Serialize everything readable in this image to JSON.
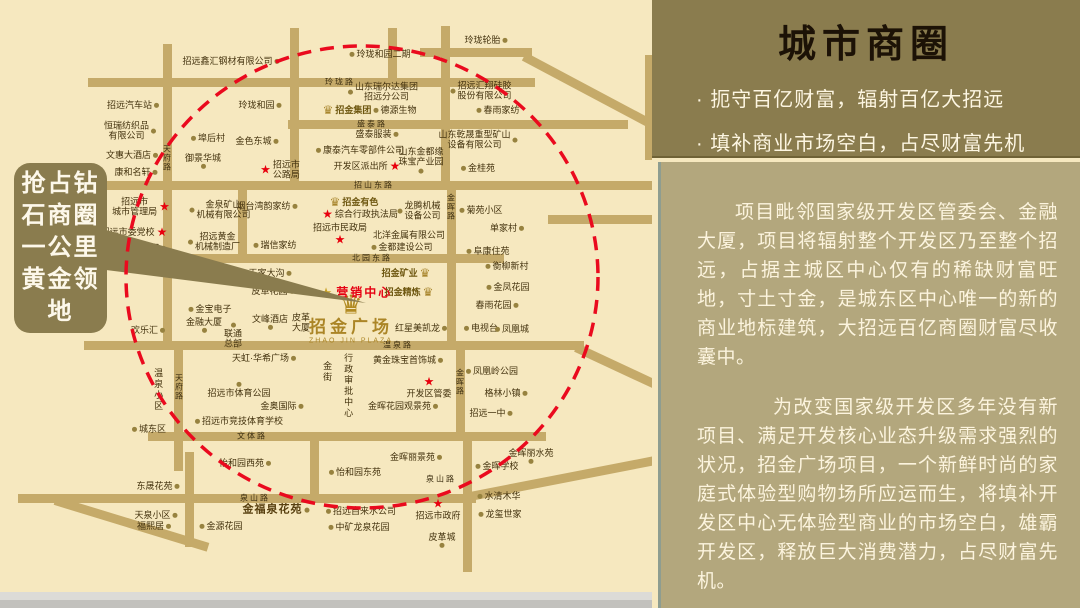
{
  "panel": {
    "title": "城市商圈",
    "bullets": [
      "· 扼守百亿财富，辐射百亿大招远",
      "· 填补商业市场空白，占尽财富先机"
    ],
    "paragraphs": [
      "项目毗邻国家级开发区管委会、金融大厦，项目将辐射整个开发区乃至整个招远，占据主城区中心仅有的稀缺财富旺地，寸土寸金，是城东区中心唯一的新的商业地标建筑，大招远百亿商圈财富尽收囊中。",
      "为改变国家级开发区多年没有新项目、满足开发核心业态升级需求强烈的状况，招金广场项目，一个新鲜时尚的家庭式体验型购物场所应运而生，将填补开发区中心无体验型商业的市场空白，雄霸开发区，释放巨大消费潜力，占尽财富先机。"
    ],
    "colors": {
      "header_bg": "#8a7c4e",
      "body_bg": "#b3a77d",
      "accent_red": "#e8000d"
    }
  },
  "callout": {
    "text": "抢占钻石商圈一公里黄金领地"
  },
  "map": {
    "plaza": {
      "name": "招金广场",
      "latin": "ZHAO JIN PLAZA"
    },
    "marketing_center": "营销中心",
    "circle_color": "#ea0a1e",
    "roads": [
      {
        "x": 88,
        "y": 78,
        "len": 447
      },
      {
        "x": 420,
        "y": 48,
        "len": 112
      },
      {
        "x": 524,
        "y": 52,
        "len": 150,
        "rot": 28
      },
      {
        "x": 288,
        "y": 120,
        "len": 340
      },
      {
        "x": 92,
        "y": 181,
        "len": 566
      },
      {
        "x": 92,
        "y": 254,
        "len": 412
      },
      {
        "x": 84,
        "y": 341,
        "len": 500
      },
      {
        "x": 576,
        "y": 343,
        "len": 125,
        "rot": 25
      },
      {
        "x": 148,
        "y": 432,
        "len": 398
      },
      {
        "x": 18,
        "y": 494,
        "len": 458
      },
      {
        "x": 470,
        "y": 492,
        "len": 195,
        "rot": -11
      },
      {
        "x": 55,
        "y": 496,
        "len": 160,
        "rot": 17
      },
      {
        "x": 548,
        "y": 215,
        "len": 104
      },
      {
        "x": 163,
        "y": 44,
        "len": 302,
        "v": 1
      },
      {
        "x": 174,
        "y": 341,
        "len": 130,
        "v": 1
      },
      {
        "x": 290,
        "y": 28,
        "len": 158,
        "v": 1
      },
      {
        "x": 441,
        "y": 26,
        "len": 158,
        "v": 1
      },
      {
        "x": 447,
        "y": 181,
        "len": 163,
        "v": 1
      },
      {
        "x": 456,
        "y": 341,
        "len": 95,
        "v": 1
      },
      {
        "x": 463,
        "y": 432,
        "len": 140,
        "v": 1
      },
      {
        "x": 310,
        "y": 432,
        "len": 68,
        "v": 1
      },
      {
        "x": 185,
        "y": 452,
        "len": 95,
        "v": 1
      },
      {
        "x": 238,
        "y": 181,
        "len": 76,
        "v": 1
      },
      {
        "x": 388,
        "y": 28,
        "len": 56,
        "v": 1
      },
      {
        "x": 645,
        "y": 55,
        "len": 105,
        "v": 1
      }
    ],
    "road_labels": [
      {
        "t": "玲珑路",
        "x": 340,
        "y": 82
      },
      {
        "t": "盛泰路",
        "x": 372,
        "y": 124
      },
      {
        "t": "招山东路",
        "x": 374,
        "y": 185
      },
      {
        "t": "北园东路",
        "x": 372,
        "y": 258
      },
      {
        "t": "温泉路",
        "x": 398,
        "y": 345
      },
      {
        "t": "文体路",
        "x": 252,
        "y": 436
      },
      {
        "t": "泉山路",
        "x": 255,
        "y": 498
      },
      {
        "t": "泉山路",
        "x": 441,
        "y": 479
      },
      {
        "t": "天府路",
        "x": 167,
        "y": 158,
        "v": 1
      },
      {
        "t": "天府路",
        "x": 179,
        "y": 387,
        "v": 1
      },
      {
        "t": "金晖路",
        "x": 451,
        "y": 207,
        "v": 1
      },
      {
        "t": "金晖路",
        "x": 460,
        "y": 382,
        "v": 1
      }
    ],
    "pois": [
      {
        "t": "招远鑫汇钢材有限公司",
        "x": 231,
        "y": 61,
        "m": "d",
        "s": "r"
      },
      {
        "t": "玲珑轮胎",
        "x": 486,
        "y": 40,
        "m": "d",
        "s": "r"
      },
      {
        "t": "玲珑和园二期",
        "x": 380,
        "y": 54,
        "m": "d",
        "s": "l"
      },
      {
        "t": "招远汽车站",
        "x": 133,
        "y": 105,
        "m": "d",
        "s": "r"
      },
      {
        "t": "玲珑和园",
        "x": 260,
        "y": 105,
        "m": "d",
        "s": "r"
      },
      {
        "t": "恒瑞纺织品\n有限公司",
        "x": 130,
        "y": 131,
        "m": "d",
        "s": "r"
      },
      {
        "t": "埠后村",
        "x": 208,
        "y": 138,
        "m": "d",
        "s": "l"
      },
      {
        "t": "金色东城",
        "x": 257,
        "y": 141,
        "m": "d",
        "s": "r"
      },
      {
        "t": "文惠大酒店",
        "x": 132,
        "y": 155,
        "m": "d",
        "s": "r"
      },
      {
        "t": "御景华城",
        "x": 203,
        "y": 161,
        "m": "d",
        "s": "b"
      },
      {
        "t": "康和名轩",
        "x": 136,
        "y": 172,
        "m": "d",
        "s": "r"
      },
      {
        "t": "山东瑞尔达集团\n招远分公司",
        "x": 383,
        "y": 92,
        "m": "d",
        "s": "l"
      },
      {
        "t": "招远汇翔硅胶\n股份有限公司",
        "x": 481,
        "y": 91,
        "m": "d",
        "s": "l"
      },
      {
        "t": "招金集团",
        "x": 347,
        "y": 110,
        "cls": "gold",
        "m": "e",
        "s": "l"
      },
      {
        "t": "德源生物",
        "x": 395,
        "y": 110,
        "m": "d",
        "s": "l"
      },
      {
        "t": "春雨家纺",
        "x": 498,
        "y": 110,
        "m": "d",
        "s": "l"
      },
      {
        "t": "盛泰服装",
        "x": 377,
        "y": 134,
        "m": "d",
        "s": "r"
      },
      {
        "t": "山东乾晟重型矿山\n设备有限公司",
        "x": 478,
        "y": 140,
        "m": "d",
        "s": "r"
      },
      {
        "t": "康泰汽车零部件公司",
        "x": 360,
        "y": 150,
        "m": "d",
        "s": "l"
      },
      {
        "t": "山东金都缘\n珠宝产业园",
        "x": 421,
        "y": 160,
        "m": "d",
        "s": "b"
      },
      {
        "t": "开发区派出所",
        "x": 367,
        "y": 166,
        "m": "s",
        "s": "r"
      },
      {
        "t": "金桂苑",
        "x": 478,
        "y": 168,
        "m": "d",
        "s": "l"
      },
      {
        "t": "招远市\n公路局",
        "x": 280,
        "y": 170,
        "m": "s",
        "s": "l"
      },
      {
        "t": "招金有色",
        "x": 354,
        "y": 202,
        "cls": "gold",
        "m": "e",
        "s": "l"
      },
      {
        "t": "综合行政执法局",
        "x": 360,
        "y": 214,
        "m": "s",
        "s": "l"
      },
      {
        "t": "龙腾机械\n设备公司",
        "x": 419,
        "y": 211,
        "m": "d",
        "s": "l"
      },
      {
        "t": "菊苑小区",
        "x": 481,
        "y": 210,
        "m": "d",
        "s": "l"
      },
      {
        "t": "单家村",
        "x": 507,
        "y": 228,
        "m": "d",
        "s": "r"
      },
      {
        "t": "招远市\n城市管理局",
        "x": 141,
        "y": 207,
        "m": "s",
        "s": "r"
      },
      {
        "t": "招远市委党校",
        "x": 134,
        "y": 232,
        "m": "s",
        "s": "r"
      },
      {
        "t": "御金都",
        "x": 149,
        "y": 248,
        "m": "d",
        "s": "r"
      },
      {
        "t": "金泉矿山\n机械有限公司",
        "x": 220,
        "y": 210,
        "m": "d",
        "s": "l"
      },
      {
        "t": "烟台湾韵家纺",
        "x": 267,
        "y": 206,
        "m": "d",
        "s": "r"
      },
      {
        "t": "招远黄金\n机械制造厂",
        "x": 214,
        "y": 242,
        "m": "d",
        "s": "l"
      },
      {
        "t": "瑞信家纺",
        "x": 275,
        "y": 245,
        "m": "d",
        "s": "l"
      },
      {
        "t": "招远市民政局",
        "x": 340,
        "y": 234,
        "m": "s",
        "s": "b"
      },
      {
        "t": "北洋金属有限公司",
        "x": 409,
        "y": 235
      },
      {
        "t": "金都建设公司",
        "x": 402,
        "y": 247,
        "m": "d",
        "s": "l"
      },
      {
        "t": "阜康住苑",
        "x": 488,
        "y": 251,
        "m": "d",
        "s": "l"
      },
      {
        "t": "御金府",
        "x": 206,
        "y": 271,
        "m": "d",
        "s": "l"
      },
      {
        "t": "王家大沟",
        "x": 270,
        "y": 273,
        "m": "d",
        "s": "r"
      },
      {
        "t": "皮革花园",
        "x": 273,
        "y": 291,
        "m": "d",
        "s": "r"
      },
      {
        "t": "衡柳新村",
        "x": 507,
        "y": 266,
        "m": "d",
        "s": "l"
      },
      {
        "t": "金凤花园",
        "x": 508,
        "y": 287,
        "m": "d",
        "s": "l"
      },
      {
        "t": "春雨花园",
        "x": 497,
        "y": 305,
        "m": "d",
        "s": "r"
      },
      {
        "t": "招金矿业",
        "x": 406,
        "y": 273,
        "cls": "gold",
        "m": "e",
        "s": "r"
      },
      {
        "t": "招金精炼",
        "x": 409,
        "y": 292,
        "cls": "gold",
        "m": "e",
        "s": "r"
      },
      {
        "t": "红星美凯龙",
        "x": 421,
        "y": 328,
        "m": "d",
        "s": "r"
      },
      {
        "t": "电视台",
        "x": 481,
        "y": 328,
        "m": "d",
        "s": "l"
      },
      {
        "t": "凤凰城",
        "x": 512,
        "y": 329,
        "m": "d",
        "s": "l"
      },
      {
        "t": "皮革\n大厦",
        "x": 301,
        "y": 323
      },
      {
        "t": "文峰酒店",
        "x": 270,
        "y": 322,
        "m": "d",
        "s": "b"
      },
      {
        "t": "金宝电子",
        "x": 210,
        "y": 309,
        "m": "d",
        "s": "l"
      },
      {
        "t": "金融大厦",
        "x": 204,
        "y": 325,
        "m": "d",
        "s": "b"
      },
      {
        "t": "联通\n总部",
        "x": 233,
        "y": 336,
        "m": "d",
        "s": "a"
      },
      {
        "t": "欢乐汇",
        "x": 148,
        "y": 330,
        "m": "d",
        "s": "r"
      },
      {
        "t": "黄金珠宝首饰城",
        "x": 408,
        "y": 360,
        "m": "d",
        "s": "r"
      },
      {
        "t": "开发区管委",
        "x": 429,
        "y": 387,
        "m": "s",
        "s": "a"
      },
      {
        "t": "凤凰岭公园",
        "x": 492,
        "y": 371,
        "m": "d",
        "s": "l"
      },
      {
        "t": "格林小镇",
        "x": 506,
        "y": 393,
        "m": "d",
        "s": "r"
      },
      {
        "t": "金晖花园观景苑",
        "x": 403,
        "y": 406,
        "m": "d",
        "s": "r"
      },
      {
        "t": "招远一中",
        "x": 491,
        "y": 413,
        "m": "d",
        "s": "r"
      },
      {
        "t": "天虹·华希广场",
        "x": 264,
        "y": 358,
        "m": "d",
        "s": "r"
      },
      {
        "t": "招远市体育公园",
        "x": 239,
        "y": 390,
        "m": "d",
        "s": "a"
      },
      {
        "t": "金奥国际",
        "x": 282,
        "y": 406,
        "m": "d",
        "s": "r"
      },
      {
        "t": "招远市竞技体育学校",
        "x": 239,
        "y": 421,
        "m": "d",
        "s": "l"
      },
      {
        "t": "城东区",
        "x": 149,
        "y": 429,
        "m": "d",
        "s": "l"
      },
      {
        "t": "温泉小区",
        "x": 158,
        "y": 390,
        "cls": "v"
      },
      {
        "t": "金街",
        "x": 327,
        "y": 372,
        "cls": "v"
      },
      {
        "t": "行政审批中心",
        "x": 348,
        "y": 386,
        "cls": "v"
      },
      {
        "t": "怡和园西苑",
        "x": 245,
        "y": 463,
        "m": "d",
        "s": "r"
      },
      {
        "t": "怡和园东苑",
        "x": 355,
        "y": 472,
        "m": "d",
        "s": "l"
      },
      {
        "t": "金晖丽景苑",
        "x": 416,
        "y": 457,
        "m": "d",
        "s": "r"
      },
      {
        "t": "金晖学校",
        "x": 497,
        "y": 466,
        "m": "d",
        "s": "l"
      },
      {
        "t": "金晖丽水苑",
        "x": 531,
        "y": 456,
        "m": "d",
        "s": "b"
      },
      {
        "t": "招远市政府",
        "x": 438,
        "y": 509,
        "m": "s",
        "s": "a"
      },
      {
        "t": "水清木华",
        "x": 499,
        "y": 496,
        "m": "d",
        "s": "l"
      },
      {
        "t": "龙玺世家",
        "x": 500,
        "y": 514,
        "m": "d",
        "s": "l"
      },
      {
        "t": "皮革城",
        "x": 442,
        "y": 540,
        "m": "d",
        "s": "b"
      },
      {
        "t": "金福泉花苑",
        "x": 276,
        "y": 510,
        "cls": "big",
        "m": "d",
        "s": "r"
      },
      {
        "t": "招远自来水公司",
        "x": 361,
        "y": 511,
        "m": "d",
        "s": "l"
      },
      {
        "t": "中矿龙泉花园",
        "x": 359,
        "y": 527,
        "m": "d",
        "s": "l"
      },
      {
        "t": "金源花园",
        "x": 221,
        "y": 526,
        "m": "d",
        "s": "l"
      },
      {
        "t": "东晟花苑",
        "x": 158,
        "y": 486,
        "m": "d",
        "s": "r"
      },
      {
        "t": "天泉小区",
        "x": 156,
        "y": 515,
        "m": "d",
        "s": "r"
      },
      {
        "t": "福熙居",
        "x": 154,
        "y": 526,
        "m": "d",
        "s": "r"
      }
    ]
  }
}
